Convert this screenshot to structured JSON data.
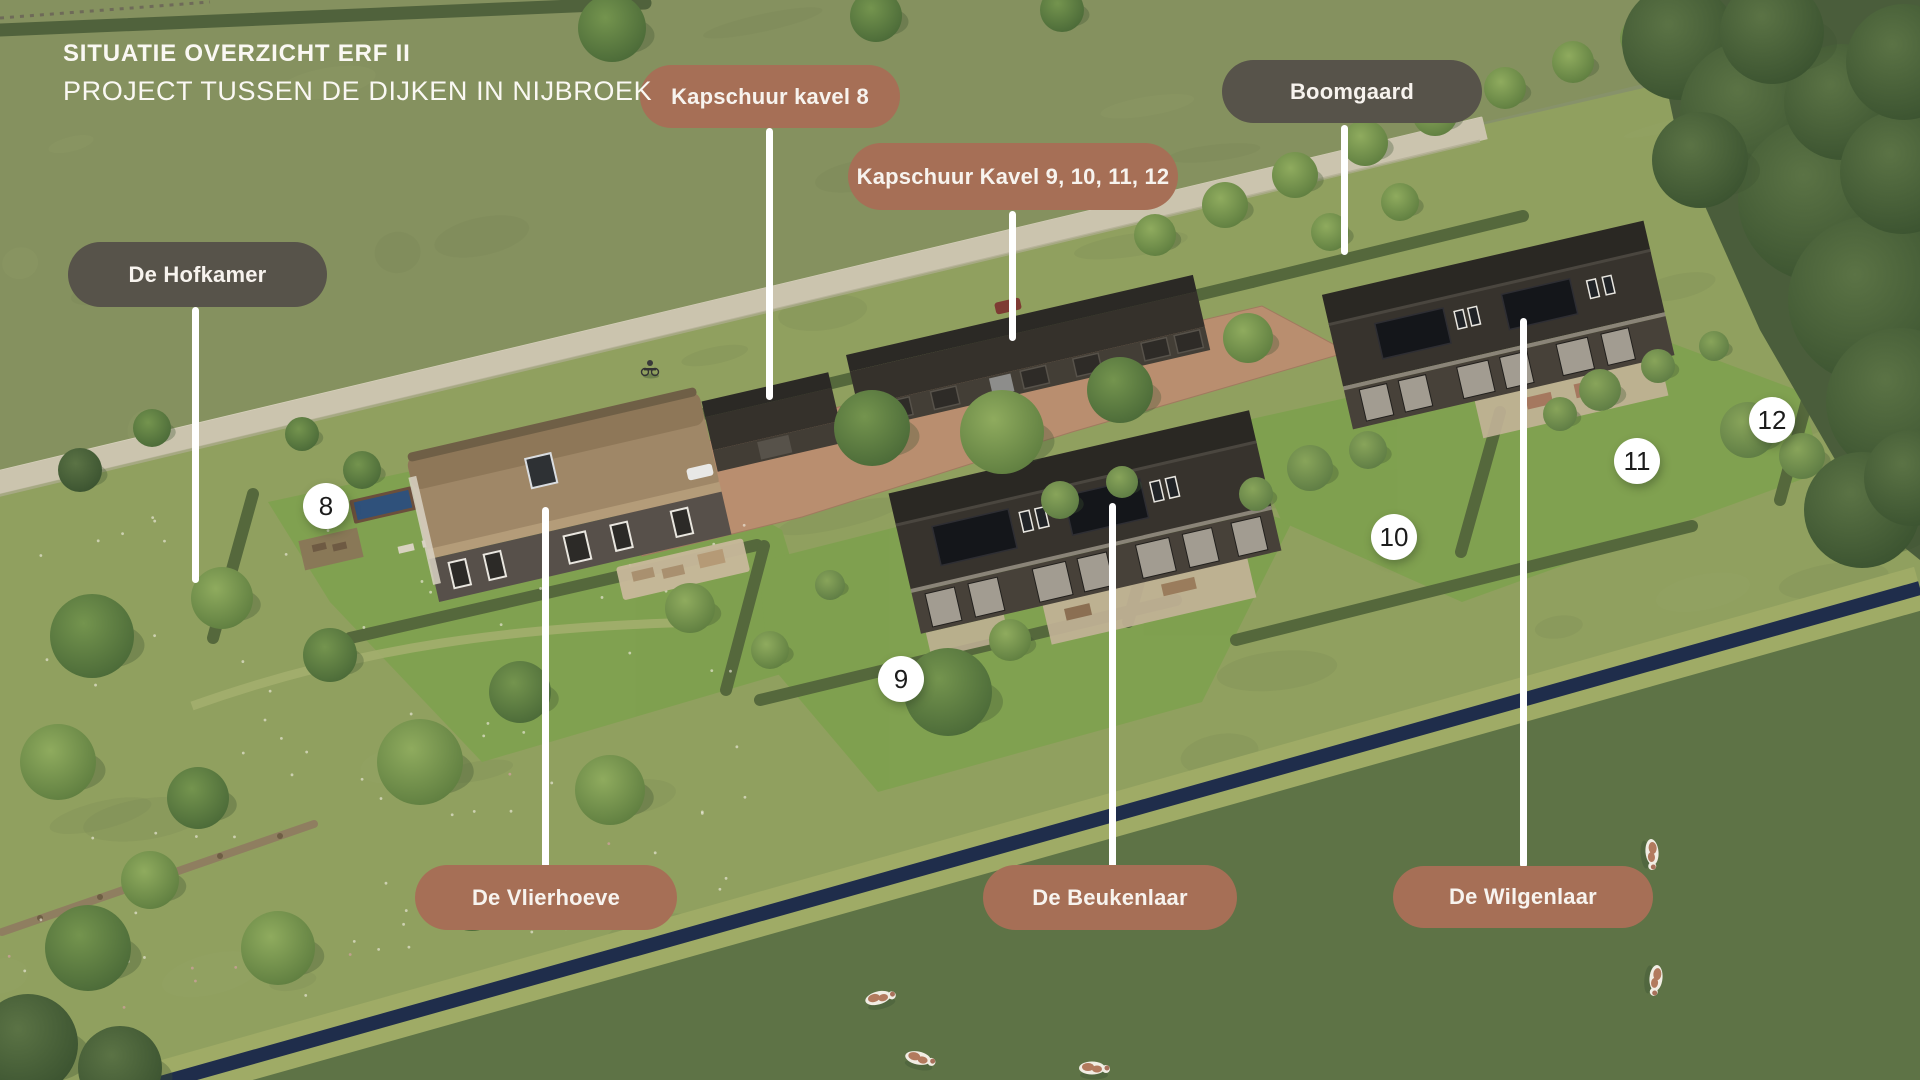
{
  "title": {
    "line1": "SITUATIE OVERZICHT ERF II",
    "line2": "PROJECT TUSSEN DE DIJKEN IN NIJBROEK"
  },
  "labels": [
    {
      "id": "kapschuur-kavel-8",
      "text": "Kapschuur kavel 8",
      "color": "#A66F56"
    },
    {
      "id": "kapschuur-kavel-9-10-11-12",
      "text": "Kapschuur Kavel 9, 10, 11, 12",
      "color": "#A66F56"
    },
    {
      "id": "boomgaard",
      "text": "Boomgaard",
      "color": "#57534A"
    },
    {
      "id": "de-hofkamer",
      "text": "De Hofkamer",
      "color": "#57534A"
    },
    {
      "id": "de-vlierhoeve",
      "text": "De Vlierhoeve",
      "color": "#A66F56"
    },
    {
      "id": "de-beukenlaar",
      "text": "De Beukenlaar",
      "color": "#A66F56"
    },
    {
      "id": "de-wilgenlaar",
      "text": "De Wilgenlaar",
      "color": "#A66F56"
    }
  ],
  "markers": [
    {
      "number": "8"
    },
    {
      "number": "9"
    },
    {
      "number": "10"
    },
    {
      "number": "11"
    },
    {
      "number": "12"
    }
  ],
  "colors": {
    "label_brown": "#A66F56",
    "label_olive": "#57534A",
    "label_text": "#F7F3EE",
    "marker_bg": "#FFFFFF",
    "marker_text": "#1C1C1C",
    "leader_line": "#FFFFFF"
  }
}
